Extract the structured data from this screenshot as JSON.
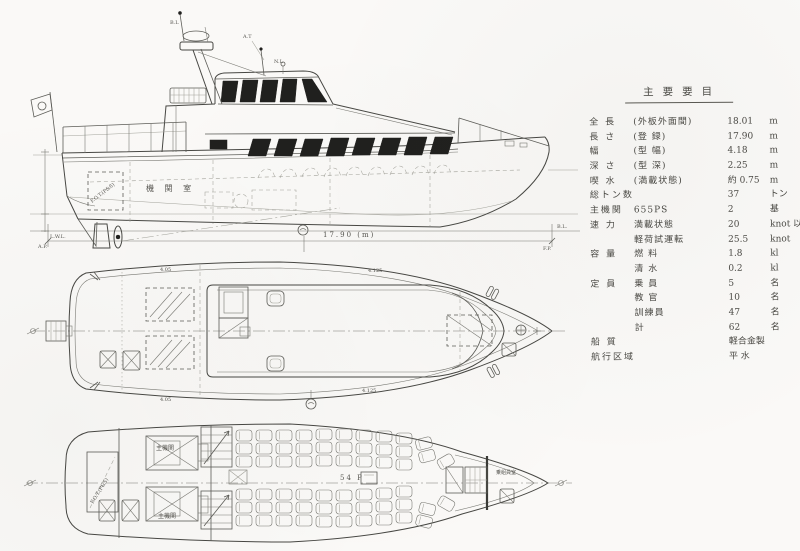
{
  "spec_table": {
    "title": "主要要目",
    "rows": [
      {
        "label": "全 長",
        "sub": "(外板外面間)",
        "value": "18.01",
        "unit": "m"
      },
      {
        "label": "長 さ",
        "sub": "(登 録)",
        "value": "17.90",
        "unit": "m"
      },
      {
        "label": "幅",
        "sub": "(型 幅)",
        "value": "4.18",
        "unit": "m"
      },
      {
        "label": "深 さ",
        "sub": "(型 深)",
        "value": "2.25",
        "unit": "m"
      },
      {
        "label": "喫 水",
        "sub": "(満載状態)",
        "value": "約 0.75",
        "unit": "m"
      },
      {
        "label": "総トン数",
        "sub": "",
        "value": "37",
        "unit": "トン"
      },
      {
        "label": "主機関",
        "sub": "655PS",
        "value": "2",
        "unit": "基"
      },
      {
        "label": "速 力",
        "sub": "満載状態",
        "value": "20",
        "unit": "knot 以上"
      },
      {
        "label": "",
        "sub": "軽荷試運転",
        "value": "25.5",
        "unit": "knot"
      },
      {
        "label": "容 量",
        "sub": "燃 料",
        "value": "1.8",
        "unit": "kl"
      },
      {
        "label": "",
        "sub": "清 水",
        "value": "0.2",
        "unit": "kl"
      },
      {
        "label": "定 員",
        "sub": "乗 員",
        "value": "5",
        "unit": "名"
      },
      {
        "label": "",
        "sub": "教 官",
        "value": "10",
        "unit": "名"
      },
      {
        "label": "",
        "sub": "訓練員",
        "value": "47",
        "unit": "名"
      },
      {
        "label": "",
        "sub": "計",
        "value": "62",
        "unit": "名"
      },
      {
        "label": "船 質",
        "sub": "",
        "value": "軽合金製",
        "unit": ""
      },
      {
        "label": "航行区域",
        "sub": "",
        "value": "平 水",
        "unit": ""
      }
    ]
  },
  "side_view": {
    "labels": {
      "mast_top": "B.L",
      "aerial": "A.T",
      "nav_light": "N.L",
      "engine_room": "機 関 室",
      "fuel_tank": "F.O.T.(P&S)",
      "lwl": "L.W.L.",
      "ap": "A.P.",
      "fp": "F.P.",
      "baseline": "B.L.",
      "length_dim": "17.90 (m)"
    }
  },
  "deck_plan": {
    "labels": {
      "dim_top_left": "4.05",
      "dim_top_right": "4.125",
      "dim_bottom_left": "4.05",
      "dim_bottom_right": "4.125"
    }
  },
  "lower_deck_plan": {
    "labels": {
      "engine_1": "主機関",
      "engine_2": "主機関",
      "fuel_tank": "F.O.T.(P&S)",
      "seat_count": "54 P",
      "crew_room": "乗組員室"
    }
  },
  "colors": {
    "paper": "#faf9f7",
    "ink": "#474743",
    "window_fill": "#20201e"
  }
}
